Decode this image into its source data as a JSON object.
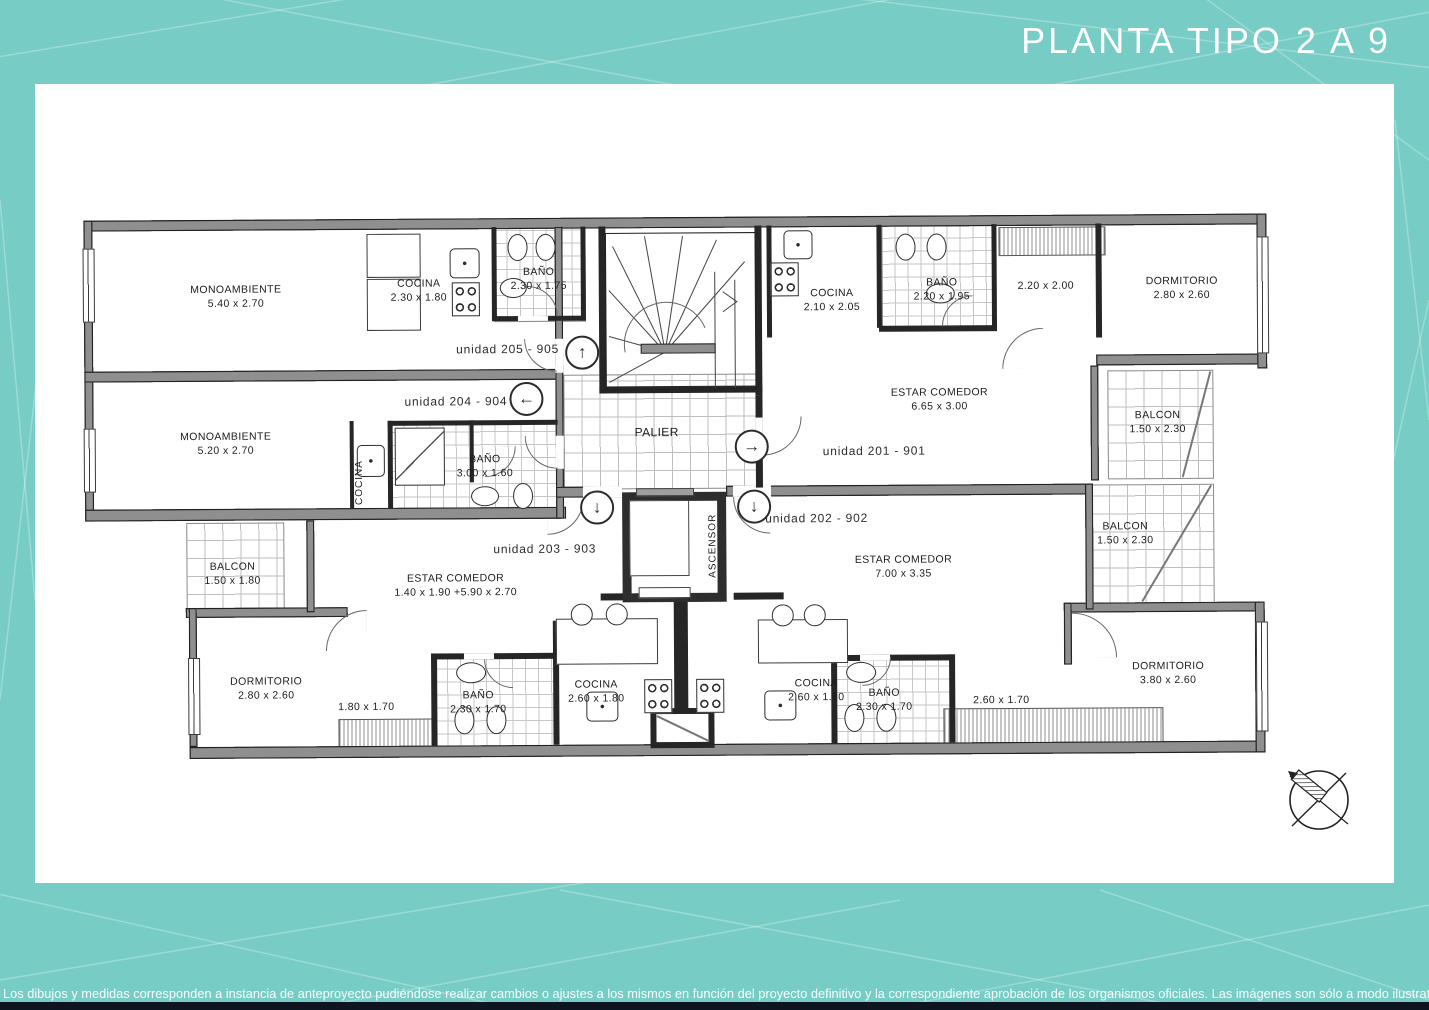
{
  "title": "PLANTA TIPO 2 A 9",
  "disclaimer": "Los dibujos y medidas corresponden a instancia de anteproyecto pudiéndose realizar cambios o ajustes a los mismos en función del proyecto definitivo y la correspondiente aprobación de los organismos oficiales. Las imágenes son sólo a modo ilustrativo",
  "colors": {
    "background": "#77ccc5",
    "panel": "#ffffff",
    "wall_fill": "#8f8f8f",
    "line": "#222222",
    "footer_bar": "#0e1420"
  },
  "core": {
    "palier": "PALIER",
    "ascensor": "ASCENSOR"
  },
  "icons": {
    "up": "↑",
    "left": "←",
    "right": "→",
    "down": "↓"
  },
  "unit_labels": {
    "u205": "unidad 205 - 905",
    "u204": "unidad 204 - 904",
    "u203": "unidad 203 - 903",
    "u202": "unidad 202 - 902",
    "u201": "unidad 201 - 901"
  },
  "rooms": {
    "mono205": {
      "name": "MONOAMBIENTE",
      "dims": "5.40 x 2.70"
    },
    "cocina205": {
      "name": "COCINA",
      "dims": "2.30 x 1.80"
    },
    "bano205": {
      "name": "BAÑO",
      "dims": "2.30 x 1.75"
    },
    "mono204": {
      "name": "MONOAMBIENTE",
      "dims": "5.20 x 2.70"
    },
    "cocina204": {
      "name": "COCINA"
    },
    "bano204": {
      "name": "BAÑO",
      "dims": "3.00 x 1.60"
    },
    "cocina201": {
      "name": "COCINA",
      "dims": "2.10 x 2.05"
    },
    "bano201": {
      "name": "BAÑO",
      "dims": "2.20 x 1.95"
    },
    "hall201": {
      "dims": "2.20 x 2.00"
    },
    "dorm201": {
      "name": "DORMITORIO",
      "dims": "2.80 x 2.60"
    },
    "estar201": {
      "name": "ESTAR COMEDOR",
      "dims": "6.65 x 3.00"
    },
    "balcon201": {
      "name": "BALCON",
      "dims": "1.50 x 2.30"
    },
    "estar202": {
      "name": "ESTAR COMEDOR",
      "dims": "7.00 x 3.35"
    },
    "balcon202": {
      "name": "BALCON",
      "dims": "1.50 x 2.30"
    },
    "cocina202": {
      "name": "COCINA",
      "dims": "2.60 x 1.80"
    },
    "bano202": {
      "name": "BAÑO",
      "dims": "2.30 x 1.70"
    },
    "hall202": {
      "dims": "2.60 x 1.70"
    },
    "dorm202": {
      "name": "DORMITORIO",
      "dims": "3.80 x 2.60"
    },
    "estar203": {
      "name": "ESTAR COMEDOR",
      "dims": "1.40 x 1.90 +5.90 x 2.70"
    },
    "balcon203": {
      "name": "BALCON",
      "dims": "1.50 x 1.80"
    },
    "dorm203": {
      "name": "DORMITORIO",
      "dims": "2.80 x 2.60"
    },
    "hall203": {
      "dims": "1.80 x 1.70"
    },
    "bano203": {
      "name": "BAÑO",
      "dims": "2.30 x 1.70"
    },
    "cocina203": {
      "name": "COCINA",
      "dims": "2.60 x 1.80"
    }
  }
}
